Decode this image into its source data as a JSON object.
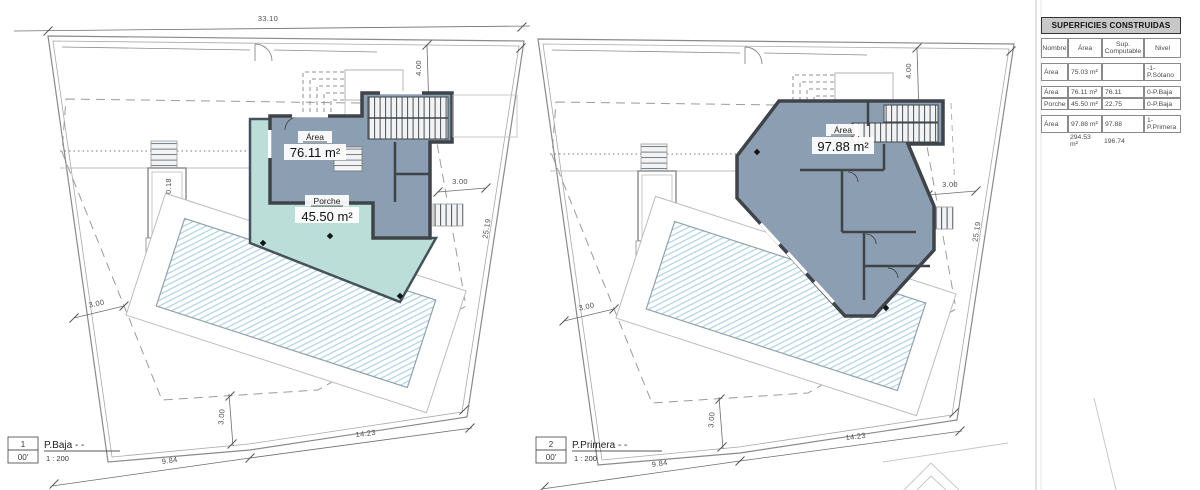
{
  "drawing": {
    "plans": [
      {
        "index": "1",
        "level_code": "00'",
        "title": "P.Baja - -",
        "scale": "1 : 200",
        "area_label": "Área",
        "area_value": "76.11 m²",
        "porch_label": "Porche",
        "porch_value": "45.50 m²",
        "dims": {
          "width_top": "33.10",
          "setback_top": "4.00",
          "setback_right": "3.00",
          "boundary_right": "25.19",
          "wall_offset": "0.18",
          "setback_left": "3.00",
          "setback_bottom": "3.00",
          "boundary_bottom": "14.23",
          "boundary_bottom_left": "9.84"
        }
      },
      {
        "index": "2",
        "level_code": "00'",
        "title": "P.Primera - -",
        "scale": "1 : 200",
        "area_label": "Área",
        "area_value": "97.88 m²",
        "dims": {
          "setback_top": "4.00",
          "setback_right": "3.00",
          "boundary_right": "25.19",
          "setback_left": "3.00",
          "setback_bottom": "3.00",
          "boundary_bottom": "14.23",
          "boundary_bottom_left": "9.84"
        }
      }
    ]
  },
  "table": {
    "title": "SUPERFICIES CONSTRUIDAS",
    "columns": [
      "Nombre",
      "Área",
      "Sup. Computable",
      "Nivel"
    ],
    "rows": [
      {
        "nombre": "Área",
        "area": "75.03 m²",
        "computable": "",
        "nivel": "-1-P.Sótano"
      },
      {
        "nombre": "Área",
        "area": "76.11 m²",
        "computable": "76.11",
        "nivel": "0-P.Baja"
      },
      {
        "nombre": "Porche",
        "area": "45.50 m²",
        "computable": "22.75",
        "nivel": "0-P.Baja"
      },
      {
        "nombre": "Área",
        "area": "97.88 m²",
        "computable": "97.88",
        "nivel": "1-P.Primera"
      }
    ],
    "totals": {
      "area": "294.53 m²",
      "computable": "196.74"
    }
  },
  "colors": {
    "building_fill": "#8C9FB2",
    "porch_fill": "#BBDFD8",
    "wall": "#3F4449",
    "pool_hatch": "#AFD3E2",
    "table_header_bg": "#C8C8C8"
  }
}
